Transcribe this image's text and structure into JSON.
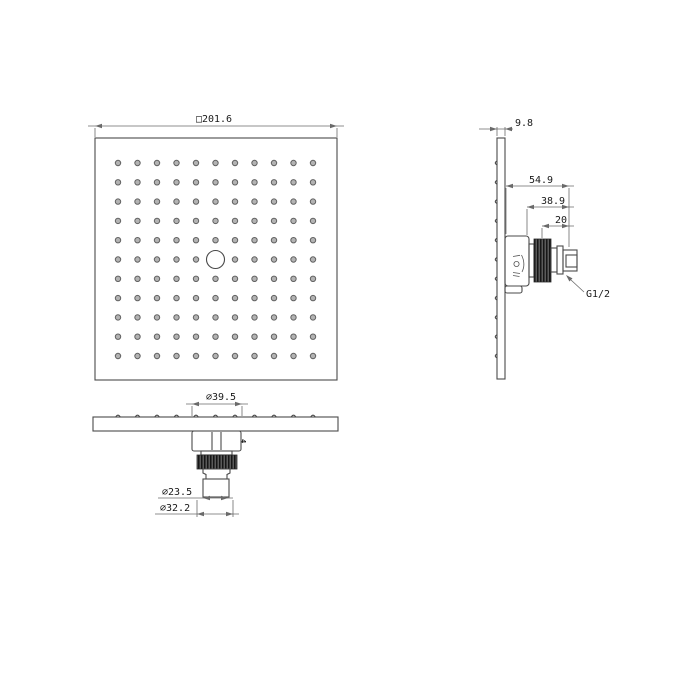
{
  "colors": {
    "background": "#ffffff",
    "object_line": "#4a4a4a",
    "dimension_line": "#6a6a6a",
    "text": "#1a1a1a",
    "nozzle_fill": "#b3b3b3",
    "nozzle_stroke": "#616161",
    "knurl_dark": "#1c1c1c",
    "knurl_light": "#6e6e6e"
  },
  "front_view": {
    "dimension_width": "□201.6",
    "nozzle_grid": {
      "rows": 11,
      "cols": 11,
      "open_center_row": 6,
      "open_center_col": 6
    }
  },
  "side_view": {
    "dimension_thickness": "9.8",
    "dimension_depth_overall": "54.9",
    "dimension_depth_hub": "38.9",
    "dimension_thread_length": "20",
    "thread_spec": "G1/2",
    "nozzle_rows": 11
  },
  "bottom_view": {
    "dimension_hub_diameter": "∅39.5",
    "dimension_thread_diameter": "∅23.5",
    "dimension_nut_diameter": "∅32.2",
    "plate_mark": "4",
    "nozzle_cols": 11
  }
}
